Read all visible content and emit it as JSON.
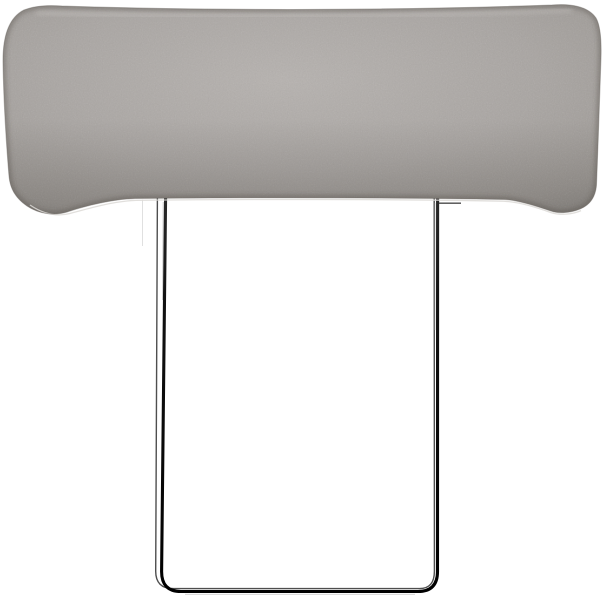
{
  "image": {
    "type": "product-photo",
    "subject": "Grey upholstered headrest cushion mounted on a thin black metal hook-over wire frame",
    "background_color": "#ffffff"
  },
  "cushion": {
    "label": "grey-fabric-cushion",
    "description": "Wide rectangular grey woven-fabric cushion with rounded corners, softly sagging bottom edge and piped seams",
    "colors": {
      "light": "#b6b2af",
      "mid": "#a9a5a2",
      "shade": "#9c9894",
      "dark": "#8c8985",
      "edge_outline": "#6e6a66",
      "piping_highlight": "#dcd9d6"
    }
  },
  "frame": {
    "label": "wire-frame",
    "description": "Thin black steel wire with two vertical legs joined by a rounded bottom crossbar; a second back wire is visible slightly offset",
    "colors": {
      "front": "#121212",
      "back": "#3b3b3b",
      "highlight": "#9f9f9f"
    }
  }
}
